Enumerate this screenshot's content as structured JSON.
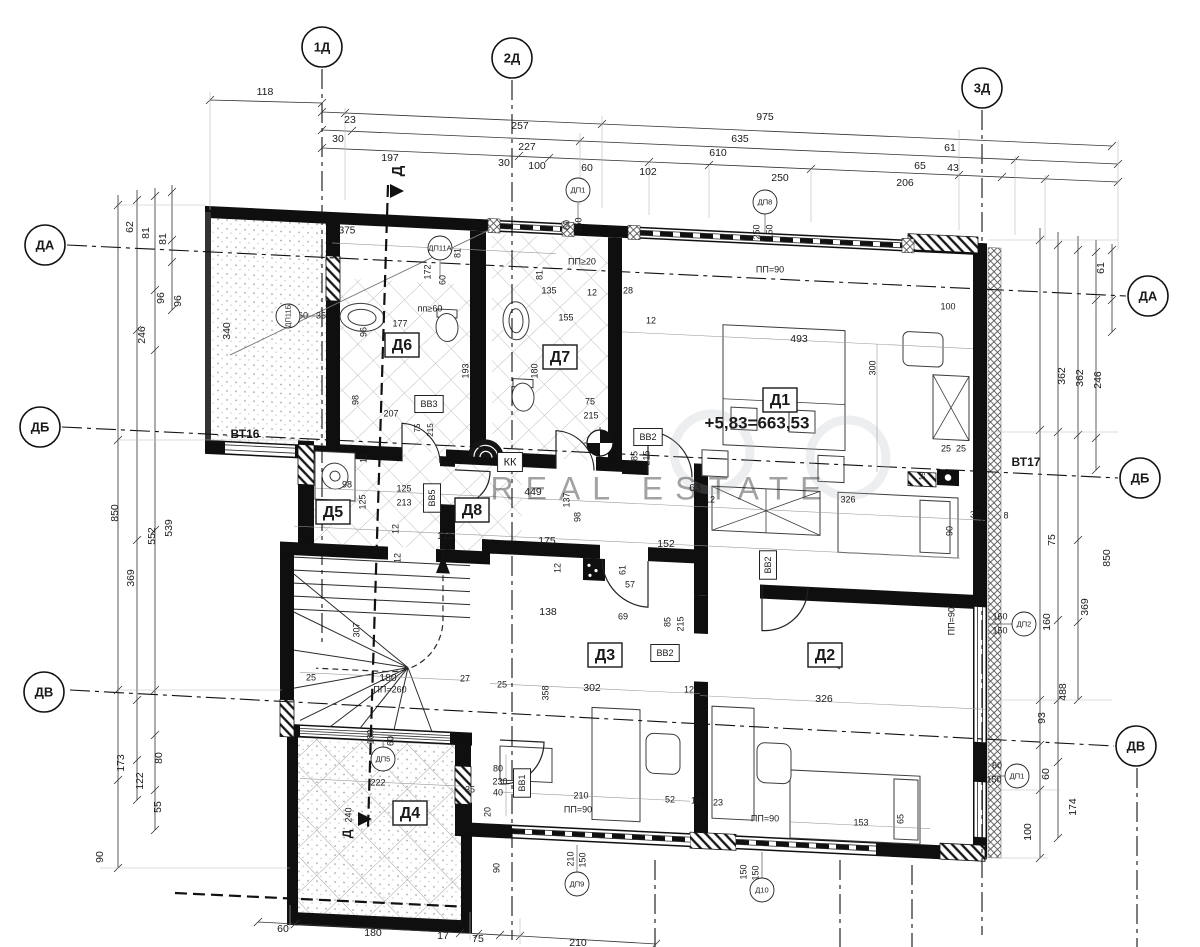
{
  "document": {
    "type": "architectural floor plan",
    "language": "bg"
  },
  "watermark": {
    "text": "REAL ESTATE"
  },
  "elevation": {
    "text": "+5,83=663,53"
  },
  "axes": {
    "top": [
      {
        "label": "1Д",
        "x": 322,
        "y": 47
      },
      {
        "label": "2Д",
        "x": 512,
        "y": 58
      },
      {
        "label": "3Д",
        "x": 982,
        "y": 88
      }
    ],
    "left": [
      {
        "label": "ДА",
        "x": 45,
        "y": 245
      },
      {
        "label": "ДБ",
        "x": 40,
        "y": 427
      },
      {
        "label": "ДВ",
        "x": 44,
        "y": 692
      }
    ],
    "right": [
      {
        "label": "ДА",
        "x": 1148,
        "y": 296
      },
      {
        "label": "ДБ",
        "x": 1140,
        "y": 478
      },
      {
        "label": "ДВ",
        "x": 1136,
        "y": 746
      }
    ]
  },
  "rooms": [
    {
      "label": "Д1",
      "x": 780,
      "y": 400
    },
    {
      "label": "Д2",
      "x": 825,
      "y": 655
    },
    {
      "label": "Д3",
      "x": 605,
      "y": 655
    },
    {
      "label": "Д4",
      "x": 410,
      "y": 813
    },
    {
      "label": "Д5",
      "x": 333,
      "y": 512
    },
    {
      "label": "Д6",
      "x": 402,
      "y": 345
    },
    {
      "label": "Д7",
      "x": 560,
      "y": 357
    },
    {
      "label": "Д8",
      "x": 472,
      "y": 510
    }
  ],
  "tags": [
    {
      "label": "ДП1",
      "x": 578,
      "y": 190
    },
    {
      "label": "ДП8",
      "x": 765,
      "y": 202
    },
    {
      "label": "ДП11А",
      "x": 440,
      "y": 248
    },
    {
      "label": "ДП11Б",
      "x": 288,
      "y": 316,
      "r": 1
    },
    {
      "label": "ДП5",
      "x": 383,
      "y": 759
    },
    {
      "label": "ДП9",
      "x": 577,
      "y": 884
    },
    {
      "label": "Д10",
      "x": 762,
      "y": 890
    },
    {
      "label": "ДП2",
      "x": 1024,
      "y": 624
    },
    {
      "label": "ДП1",
      "x": 1017,
      "y": 776
    }
  ],
  "boxes": [
    {
      "t": "КК",
      "x": 510,
      "y": 462,
      "s": 11
    },
    {
      "t": "BB3",
      "x": 429,
      "y": 404,
      "s": 9
    },
    {
      "t": "BB2",
      "x": 648,
      "y": 437,
      "s": 9
    },
    {
      "t": "BB2",
      "x": 768,
      "y": 565,
      "s": 9,
      "r": 1
    },
    {
      "t": "BB2",
      "x": 665,
      "y": 653,
      "s": 9
    },
    {
      "t": "BB5",
      "x": 432,
      "y": 498,
      "s": 9,
      "r": 1
    },
    {
      "t": "BB1",
      "x": 522,
      "y": 783,
      "s": 9,
      "r": 1
    }
  ],
  "texts": [
    {
      "t": "118",
      "x": 265,
      "y": 92
    },
    {
      "t": "23",
      "x": 350,
      "y": 120
    },
    {
      "t": "257",
      "x": 520,
      "y": 126
    },
    {
      "t": "975",
      "x": 765,
      "y": 117
    },
    {
      "t": "30",
      "x": 338,
      "y": 139
    },
    {
      "t": "227",
      "x": 527,
      "y": 147
    },
    {
      "t": "635",
      "x": 740,
      "y": 139
    },
    {
      "t": "610",
      "x": 718,
      "y": 153
    },
    {
      "t": "197",
      "x": 390,
      "y": 158
    },
    {
      "t": "30",
      "x": 504,
      "y": 163
    },
    {
      "t": "100",
      "x": 537,
      "y": 166
    },
    {
      "t": "60",
      "x": 587,
      "y": 168
    },
    {
      "t": "102",
      "x": 648,
      "y": 172
    },
    {
      "t": "250",
      "x": 780,
      "y": 178
    },
    {
      "t": "61",
      "x": 950,
      "y": 148
    },
    {
      "t": "65",
      "x": 920,
      "y": 166
    },
    {
      "t": "43",
      "x": 953,
      "y": 168
    },
    {
      "t": "206",
      "x": 905,
      "y": 183
    },
    {
      "t": "62",
      "x": 130,
      "y": 227,
      "r": 1
    },
    {
      "t": "81",
      "x": 146,
      "y": 233,
      "r": 1
    },
    {
      "t": "81",
      "x": 163,
      "y": 239,
      "r": 1
    },
    {
      "t": "96",
      "x": 161,
      "y": 298,
      "r": 1
    },
    {
      "t": "96",
      "x": 178,
      "y": 301,
      "r": 1
    },
    {
      "t": "246",
      "x": 142,
      "y": 335,
      "r": 1
    },
    {
      "t": "340",
      "x": 227,
      "y": 331,
      "r": 1
    },
    {
      "t": "850",
      "x": 115,
      "y": 513,
      "r": 1
    },
    {
      "t": "552",
      "x": 152,
      "y": 536,
      "r": 1
    },
    {
      "t": "539",
      "x": 169,
      "y": 528,
      "r": 1
    },
    {
      "t": "369",
      "x": 131,
      "y": 578,
      "r": 1
    },
    {
      "t": "173",
      "x": 121,
      "y": 763,
      "r": 1
    },
    {
      "t": "122",
      "x": 140,
      "y": 781,
      "r": 1
    },
    {
      "t": "80",
      "x": 159,
      "y": 758,
      "r": 1
    },
    {
      "t": "55",
      "x": 158,
      "y": 807,
      "r": 1
    },
    {
      "t": "90",
      "x": 100,
      "y": 857,
      "r": 1
    },
    {
      "t": "61",
      "x": 1101,
      "y": 268,
      "r": 1
    },
    {
      "t": "362",
      "x": 1062,
      "y": 376,
      "r": 1
    },
    {
      "t": "362",
      "x": 1080,
      "y": 378,
      "r": 1
    },
    {
      "t": "246",
      "x": 1098,
      "y": 380,
      "r": 1
    },
    {
      "t": "75",
      "x": 1052,
      "y": 540,
      "r": 1
    },
    {
      "t": "850",
      "x": 1107,
      "y": 558,
      "r": 1
    },
    {
      "t": "369",
      "x": 1085,
      "y": 607,
      "r": 1
    },
    {
      "t": "160",
      "x": 1047,
      "y": 622,
      "r": 1
    },
    {
      "t": "488",
      "x": 1063,
      "y": 692,
      "r": 1
    },
    {
      "t": "93",
      "x": 1042,
      "y": 718,
      "r": 1
    },
    {
      "t": "60",
      "x": 1046,
      "y": 774,
      "r": 1
    },
    {
      "t": "174",
      "x": 1073,
      "y": 807,
      "r": 1
    },
    {
      "t": "100",
      "x": 1028,
      "y": 832,
      "r": 1
    },
    {
      "t": "60",
      "x": 283,
      "y": 929
    },
    {
      "t": "180",
      "x": 373,
      "y": 933
    },
    {
      "t": "17",
      "x": 443,
      "y": 936
    },
    {
      "t": "75",
      "x": 478,
      "y": 939
    },
    {
      "t": "210",
      "x": 578,
      "y": 943
    },
    {
      "t": "375",
      "x": 347,
      "y": 231,
      "s": 10
    },
    {
      "t": "81",
      "x": 458,
      "y": 253,
      "r": 1,
      "s": 9
    },
    {
      "t": "172",
      "x": 428,
      "y": 272,
      "r": 1,
      "s": 9
    },
    {
      "t": "60",
      "x": 443,
      "y": 280,
      "r": 1,
      "s": 9
    },
    {
      "t": "пп≥60",
      "x": 430,
      "y": 309,
      "s": 9
    },
    {
      "t": "60",
      "x": 303,
      "y": 316,
      "s": 9
    },
    {
      "t": "35",
      "x": 321,
      "y": 316,
      "s": 9
    },
    {
      "t": "177",
      "x": 400,
      "y": 324,
      "s": 9
    },
    {
      "t": "96",
      "x": 364,
      "y": 332,
      "r": 1,
      "s": 9
    },
    {
      "t": "193",
      "x": 466,
      "y": 371,
      "r": 1,
      "s": 9
    },
    {
      "t": "98",
      "x": 356,
      "y": 400,
      "r": 1,
      "s": 9
    },
    {
      "t": "207",
      "x": 391,
      "y": 414,
      "s": 9
    },
    {
      "t": "75",
      "x": 418,
      "y": 428,
      "r": 1,
      "s": 8
    },
    {
      "t": "215",
      "x": 431,
      "y": 430,
      "r": 1,
      "s": 8
    },
    {
      "t": "ПП≥20",
      "x": 582,
      "y": 262,
      "s": 9
    },
    {
      "t": "135",
      "x": 549,
      "y": 291,
      "s": 9
    },
    {
      "t": "12",
      "x": 592,
      "y": 293,
      "s": 9
    },
    {
      "t": "28",
      "x": 628,
      "y": 291,
      "s": 9
    },
    {
      "t": "81",
      "x": 540,
      "y": 275,
      "r": 1,
      "s": 9
    },
    {
      "t": "155",
      "x": 566,
      "y": 318,
      "s": 9
    },
    {
      "t": "12",
      "x": 651,
      "y": 321,
      "s": 9
    },
    {
      "t": "180",
      "x": 535,
      "y": 371,
      "r": 1,
      "s": 9
    },
    {
      "t": "75",
      "x": 590,
      "y": 402,
      "s": 9
    },
    {
      "t": "215",
      "x": 591,
      "y": 416,
      "s": 9
    },
    {
      "t": "ПП=90",
      "x": 770,
      "y": 270,
      "s": 9
    },
    {
      "t": "60",
      "x": 567,
      "y": 225,
      "r": 1,
      "s": 9
    },
    {
      "t": "150",
      "x": 579,
      "y": 225,
      "r": 1,
      "s": 9
    },
    {
      "t": "250",
      "x": 757,
      "y": 232,
      "r": 1,
      "s": 9
    },
    {
      "t": "150",
      "x": 770,
      "y": 232,
      "r": 1,
      "s": 9
    },
    {
      "t": "449",
      "x": 533,
      "y": 492
    },
    {
      "t": "137",
      "x": 567,
      "y": 500,
      "r": 1,
      "s": 9
    },
    {
      "t": "98",
      "x": 578,
      "y": 517,
      "r": 1,
      "s": 9
    },
    {
      "t": "63",
      "x": 695,
      "y": 488
    },
    {
      "t": "12",
      "x": 710,
      "y": 500,
      "s": 9
    },
    {
      "t": "85",
      "x": 635,
      "y": 456,
      "r": 1,
      "s": 9
    },
    {
      "t": "215",
      "x": 647,
      "y": 458,
      "r": 1,
      "s": 9
    },
    {
      "t": "111",
      "x": 445,
      "y": 536
    },
    {
      "t": "175",
      "x": 547,
      "y": 541
    },
    {
      "t": "152",
      "x": 666,
      "y": 544
    },
    {
      "t": "12",
      "x": 558,
      "y": 568,
      "r": 1,
      "s": 9
    },
    {
      "t": "61",
      "x": 623,
      "y": 570,
      "r": 1,
      "s": 9
    },
    {
      "t": "57",
      "x": 630,
      "y": 585,
      "s": 9
    },
    {
      "t": "138",
      "x": 548,
      "y": 612
    },
    {
      "t": "69",
      "x": 623,
      "y": 617,
      "s": 9
    },
    {
      "t": "85",
      "x": 668,
      "y": 622,
      "r": 1,
      "s": 9
    },
    {
      "t": "215",
      "x": 681,
      "y": 624,
      "r": 1,
      "s": 9
    },
    {
      "t": "125",
      "x": 404,
      "y": 489,
      "s": 9
    },
    {
      "t": "213",
      "x": 404,
      "y": 503,
      "s": 9
    },
    {
      "t": "125",
      "x": 363,
      "y": 502,
      "r": 1,
      "s": 9
    },
    {
      "t": "98",
      "x": 347,
      "y": 485,
      "s": 9
    },
    {
      "t": "12",
      "x": 364,
      "y": 458,
      "r": 1,
      "s": 9
    },
    {
      "t": "12",
      "x": 396,
      "y": 529,
      "r": 1,
      "s": 9
    },
    {
      "t": "307",
      "x": 357,
      "y": 630,
      "r": 1,
      "s": 9
    },
    {
      "t": "180",
      "x": 388,
      "y": 678
    },
    {
      "t": "ПП=260",
      "x": 390,
      "y": 690,
      "s": 9
    },
    {
      "t": "25",
      "x": 311,
      "y": 678,
      "s": 9
    },
    {
      "t": "27",
      "x": 465,
      "y": 679,
      "s": 9
    },
    {
      "t": "25",
      "x": 502,
      "y": 685,
      "s": 9
    },
    {
      "t": "12",
      "x": 398,
      "y": 558,
      "r": 1,
      "s": 9
    },
    {
      "t": "180",
      "x": 371,
      "y": 737,
      "r": 1,
      "s": 9
    },
    {
      "t": "60",
      "x": 391,
      "y": 741,
      "r": 1,
      "s": 9
    },
    {
      "t": "222",
      "x": 378,
      "y": 783,
      "s": 9
    },
    {
      "t": "240",
      "x": 349,
      "y": 815,
      "r": 1,
      "s": 9
    },
    {
      "t": "302",
      "x": 592,
      "y": 688
    },
    {
      "t": "12",
      "x": 689,
      "y": 690,
      "s": 9
    },
    {
      "t": "326",
      "x": 824,
      "y": 699
    },
    {
      "t": "358",
      "x": 546,
      "y": 693,
      "r": 1,
      "s": 9
    },
    {
      "t": "468",
      "x": 839,
      "y": 662,
      "r": 1,
      "s": 9
    },
    {
      "t": "80",
      "x": 498,
      "y": 769,
      "s": 9
    },
    {
      "t": "230",
      "x": 500,
      "y": 782,
      "s": 9
    },
    {
      "t": "40",
      "x": 498,
      "y": 793,
      "s": 9
    },
    {
      "t": "35",
      "x": 470,
      "y": 790,
      "s": 9
    },
    {
      "t": "20",
      "x": 488,
      "y": 812,
      "r": 1,
      "s": 9
    },
    {
      "t": "52",
      "x": 670,
      "y": 800,
      "s": 9
    },
    {
      "t": "12",
      "x": 696,
      "y": 801,
      "s": 9
    },
    {
      "t": "23",
      "x": 718,
      "y": 803,
      "s": 9
    },
    {
      "t": "210",
      "x": 581,
      "y": 796,
      "s": 9
    },
    {
      "t": "ПП=90",
      "x": 578,
      "y": 810,
      "s": 9
    },
    {
      "t": "ПП=90",
      "x": 765,
      "y": 819,
      "s": 9
    },
    {
      "t": "153",
      "x": 861,
      "y": 823,
      "s": 9
    },
    {
      "t": "65",
      "x": 901,
      "y": 819,
      "r": 1,
      "s": 9
    },
    {
      "t": "90",
      "x": 497,
      "y": 868,
      "r": 1,
      "s": 9
    },
    {
      "t": "210",
      "x": 571,
      "y": 859,
      "r": 1,
      "s": 9
    },
    {
      "t": "150",
      "x": 583,
      "y": 860,
      "r": 1,
      "s": 9
    },
    {
      "t": "150",
      "x": 744,
      "y": 872,
      "r": 1,
      "s": 9
    },
    {
      "t": "150",
      "x": 756,
      "y": 873,
      "r": 1,
      "s": 9
    },
    {
      "t": "493",
      "x": 799,
      "y": 339
    },
    {
      "t": "300",
      "x": 873,
      "y": 368,
      "r": 1,
      "s": 9
    },
    {
      "t": "100",
      "x": 948,
      "y": 307,
      "s": 9
    },
    {
      "t": "25",
      "x": 946,
      "y": 449,
      "s": 9
    },
    {
      "t": "25",
      "x": 961,
      "y": 449,
      "s": 9
    },
    {
      "t": "19",
      "x": 923,
      "y": 476,
      "r": 1,
      "s": 8
    },
    {
      "t": "326",
      "x": 848,
      "y": 500,
      "s": 9
    },
    {
      "t": "35",
      "x": 975,
      "y": 515,
      "s": 9
    },
    {
      "t": "8",
      "x": 1006,
      "y": 516,
      "s": 9
    },
    {
      "t": "90",
      "x": 950,
      "y": 531,
      "r": 1,
      "s": 9
    },
    {
      "t": "ПП=90.",
      "x": 952,
      "y": 620,
      "r": 1,
      "s": 9
    },
    {
      "t": "160",
      "x": 1000,
      "y": 617,
      "s": 9
    },
    {
      "t": "150",
      "x": 1000,
      "y": 631,
      "s": 9
    },
    {
      "t": "60",
      "x": 997,
      "y": 766,
      "s": 9
    },
    {
      "t": "150",
      "x": 994,
      "y": 780,
      "s": 9
    },
    {
      "t": "ВТ16",
      "x": 245,
      "y": 435,
      "s": 12,
      "b": 1
    },
    {
      "t": "ВТ17",
      "x": 1026,
      "y": 463,
      "s": 12,
      "b": 1
    },
    {
      "t": "+5,83=663,53",
      "x": 757,
      "y": 424,
      "s": 17,
      "b": 1
    },
    {
      "t": "Д",
      "x": 398,
      "y": 171,
      "r": 1,
      "s": 15,
      "b": 1
    },
    {
      "t": "Д",
      "x": 348,
      "y": 834,
      "r": 1,
      "s": 12,
      "b": 1
    },
    {
      "t": "REAL ESTATE",
      "x": 662,
      "y": 491,
      "s": 32,
      "c": "#a7adb3",
      "o": 0.4,
      "ls": 12
    }
  ]
}
